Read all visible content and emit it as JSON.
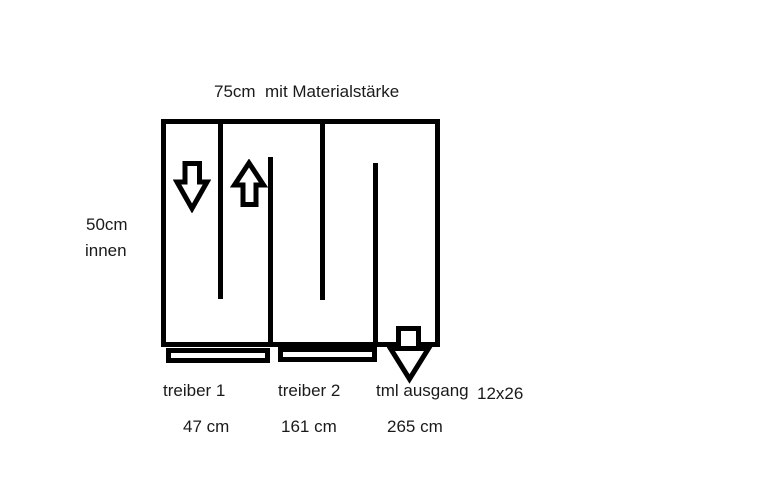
{
  "diagram": {
    "title": "75cm  mit Materialstärke",
    "left_dimension": {
      "line1": "50cm",
      "line2": "innen"
    },
    "sections": [
      {
        "label": "treiber 1",
        "measurement": "47 cm"
      },
      {
        "label": "treiber 2",
        "measurement": "161 cm"
      },
      {
        "label": "tml ausgang",
        "measurement": "265 cm"
      }
    ],
    "port_size": "12x26",
    "icons": {
      "chamber1": "down-arrow",
      "chamber2": "up-arrow",
      "output": "down-arrow"
    },
    "colors": {
      "line": "#000000",
      "background": "#ffffff",
      "text": "#1a1a1a"
    }
  }
}
